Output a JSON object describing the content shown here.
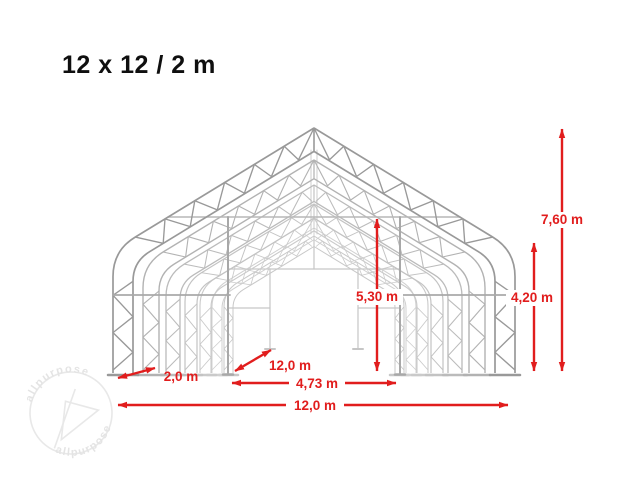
{
  "title": "12 x 12 / 2 m",
  "dimensions": {
    "total_height": "7,60 m",
    "eave_height": "4,20 m",
    "clear_height": "5,30 m",
    "bay_spacing": "2,0 m",
    "length": "12,0 m",
    "inner_width": "4,73 m",
    "total_width": "12,0 m"
  },
  "watermark": {
    "text_top": "allpurpose",
    "text_bottom": "allpurpose"
  },
  "colors": {
    "dimension_red": "#e11d1d",
    "structure_front_gray": "#999999",
    "structure_back_gray": "#d0d0d0",
    "title_black": "#0f0f0f",
    "watermark_gray": "#e8e8e8"
  }
}
